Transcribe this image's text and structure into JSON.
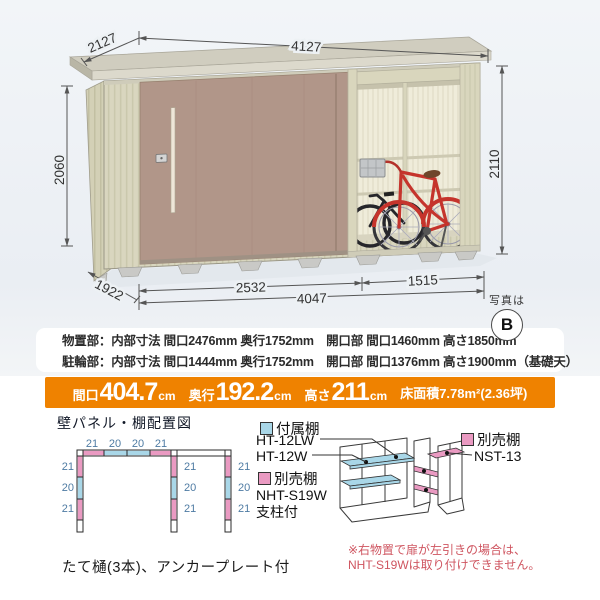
{
  "photo": {
    "dims": {
      "top_width": "4127",
      "top_depth": "2127",
      "left_height": "2060",
      "right_height": "2110",
      "bottom_depth": "1922",
      "front_left": "2532",
      "front_total": "4047",
      "front_right": "1515"
    },
    "badge": {
      "label": "写真は",
      "letter": "B"
    }
  },
  "specs": {
    "line1": "物置部：内部寸法 間口2476mm 奥行1752mm　開口部 間口1460mm 高さ1850mm",
    "line2": "駐輪部：内部寸法 間口1444mm 奥行1752mm　開口部 間口1376mm 高さ1900mm（基礎天）"
  },
  "banner": {
    "bg_color": "#ef8200",
    "items": [
      {
        "label": "間口",
        "value": "404.7",
        "unit": "cm"
      },
      {
        "label": "奥行",
        "value": "192.2",
        "unit": "cm"
      },
      {
        "label": "高さ",
        "value": "211",
        "unit": "cm"
      }
    ],
    "floor_area": "床面積7.78m²(2.36坪)"
  },
  "plan": {
    "title": "壁パネル・棚配置図",
    "top_labels": [
      "21",
      "20",
      "20",
      "21"
    ],
    "left_labels": [
      "21",
      "20",
      "21"
    ],
    "middle_labels": [
      "21",
      "20",
      "21"
    ],
    "right_labels": [
      "21",
      "20",
      "21"
    ],
    "colors": {
      "attached_shelf": "#a9d7e8",
      "optional_shelf": "#ea9ac2"
    }
  },
  "legend": {
    "attached": {
      "label": "付属棚",
      "items": [
        "HT-12LW",
        "HT-12W"
      ]
    },
    "optional_left": {
      "label": "別売棚",
      "items": [
        "NHT-S19W",
        "支柱付"
      ]
    },
    "optional_right": {
      "label": "別売棚",
      "items": [
        "NST-13"
      ]
    }
  },
  "note": {
    "color": "#cf5560",
    "line1": "※右物置で扉が左引きの場合は、",
    "line2": "NHT-S19Wは取り付けできません。"
  },
  "footer": "たて樋(3本)、アンカープレート付"
}
